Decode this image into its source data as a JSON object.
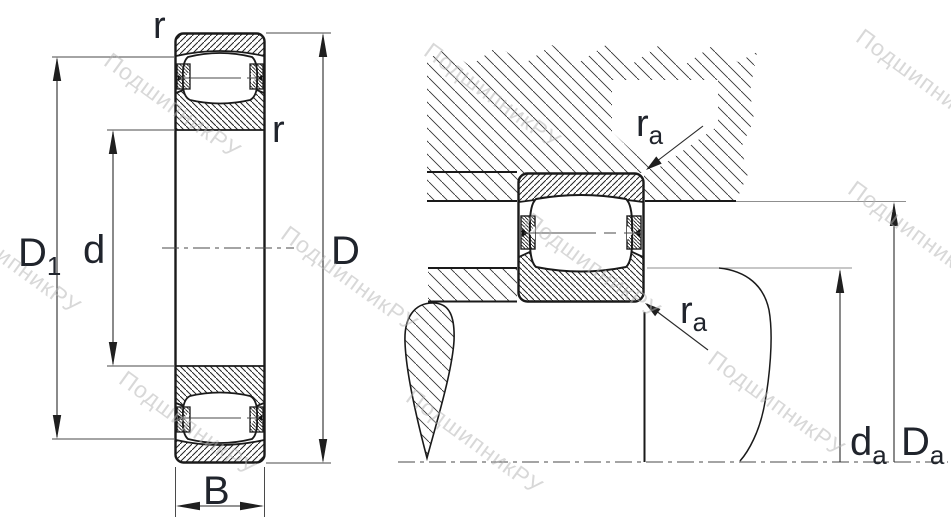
{
  "drawing_title": "barrel-roller-bearing-dimension-drawing",
  "watermark": "ПодшипникРУ",
  "labels": {
    "r": "r",
    "D1_main": "D",
    "D1_sub": "1",
    "d": "d",
    "D": "D",
    "B": "B",
    "ra_main": "r",
    "ra_sub": "a",
    "da_main": "d",
    "da_sub": "a",
    "Da_main": "D",
    "Da_sub": "a"
  },
  "colors": {
    "ink": "#1a1a1a",
    "text": "#20242c",
    "thin_line": "#4a4a4a",
    "extension_line": "#8f8f8f",
    "watermark": "#b3b3b3",
    "background": "#ffffff"
  }
}
